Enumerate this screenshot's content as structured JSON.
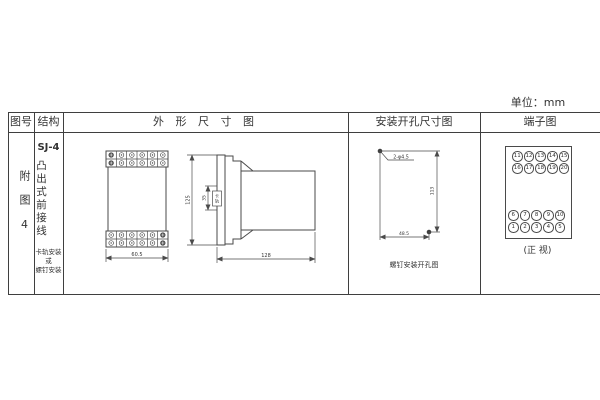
{
  "unit_label": "单位：mm",
  "table": {
    "headers": {
      "figure_no": "图号",
      "structure": "结构",
      "outline": "外 形 尺 寸 图",
      "mounting": "安装开孔尺寸图",
      "terminal": "端子图"
    }
  },
  "figure": {
    "number_vertical": "附图4"
  },
  "structure": {
    "model": "SJ-4",
    "type_vertical": "凸出式前接线",
    "mounting_lines": [
      "卡轨安装",
      "或",
      "螺钉安装"
    ]
  },
  "outline_drawing": {
    "front_width": "60.5",
    "overall_height": "125",
    "rail_dim": "35",
    "rail_label": "卡轨",
    "depth": "128"
  },
  "mounting_drawing": {
    "holes_label": "2-φ4.5",
    "vertical_dim": "113",
    "horizontal_dim": "48.5",
    "caption": "螺钉安装开孔图"
  },
  "terminal_diagram": {
    "top_rows": [
      [
        "11",
        "12",
        "13",
        "14",
        "15"
      ],
      [
        "16",
        "17",
        "18",
        "19",
        "20"
      ]
    ],
    "bottom_rows": [
      [
        "6",
        "7",
        "8",
        "9",
        "10"
      ],
      [
        "1",
        "2",
        "3",
        "4",
        "5"
      ]
    ],
    "caption": "(正 视)"
  }
}
